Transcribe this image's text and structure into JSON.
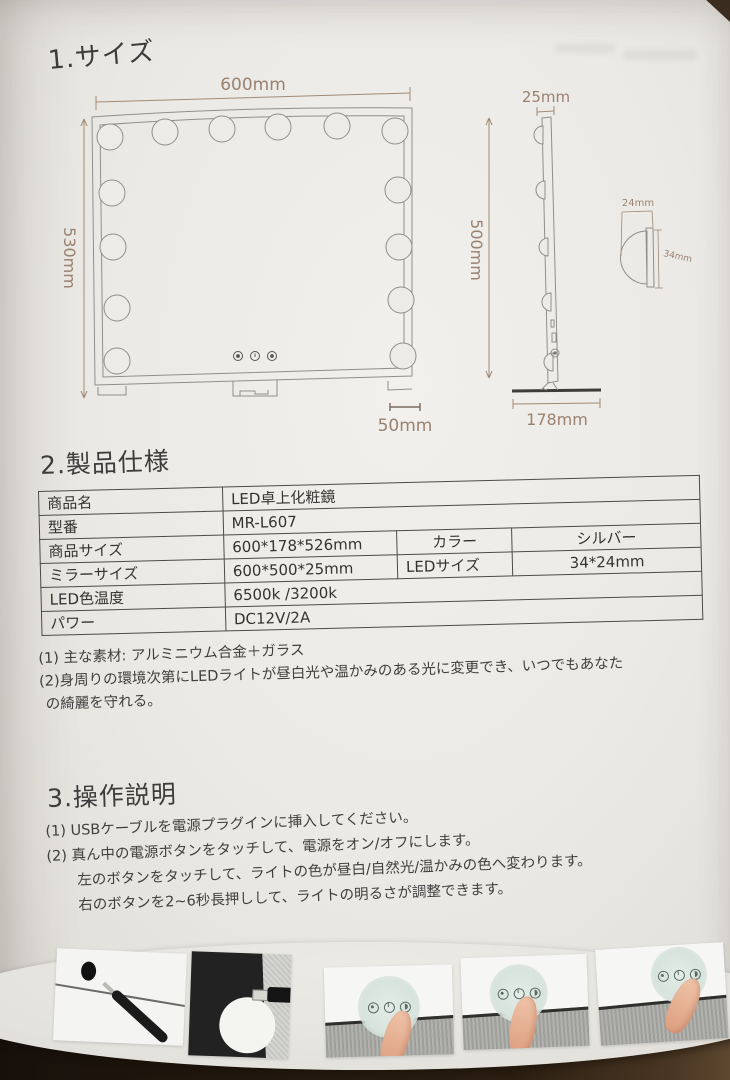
{
  "sections": {
    "size_heading": "1.サイズ",
    "spec_heading": "2.製品仕様",
    "operation_heading": "3.操作説明"
  },
  "dimensions": {
    "front_width": "600mm",
    "front_height": "530mm",
    "foot_width": "50mm",
    "side_thickness": "25mm",
    "side_height": "500mm",
    "base_depth": "178mm",
    "led_width": "24mm",
    "led_height": "34mm"
  },
  "spec_table": {
    "rows": [
      {
        "label": "商品名",
        "value": "LED卓上化粧鏡"
      },
      {
        "label": "型番",
        "value": "MR-L607"
      },
      {
        "label": "商品サイズ",
        "value": "600*178*526mm",
        "label2": "カラー",
        "value2": "シルバー"
      },
      {
        "label": "ミラーサイズ",
        "value": "600*500*25mm",
        "label2": "LEDサイズ",
        "value2": "34*24mm"
      },
      {
        "label": "LED色温度",
        "value": "6500k /3200k"
      },
      {
        "label": "パワー",
        "value": "DC12V/2A"
      }
    ]
  },
  "notes": {
    "line1": "(1) 主な素材: アルミニウム合金＋ガラス",
    "line2": "(2)身周りの環境次第にLEDライトが昼白光や温かみのある光に変更でき、いつでもあなた",
    "line3": "の綺麗を守れる。"
  },
  "instructions": {
    "line1": "(1) USBケーブルを電源プラグインに挿入してください。",
    "line2": "(2) 真ん中の電源ボタンをタッチして、電源をオン/オフにします。",
    "line3": "左のボタンをタッチして、ライトの色が昼白/自然光/温かみの色へ変わります。",
    "line4": "右のボタンを2~6秒長押しして、ライトの明るさが調整できます。"
  },
  "colors": {
    "paper": "#edebe6",
    "dimension_ink": "#9b8170",
    "line_art": "#8f8f8c",
    "table_border": "#4b4b4b",
    "body_text": "#3f3f3f"
  }
}
